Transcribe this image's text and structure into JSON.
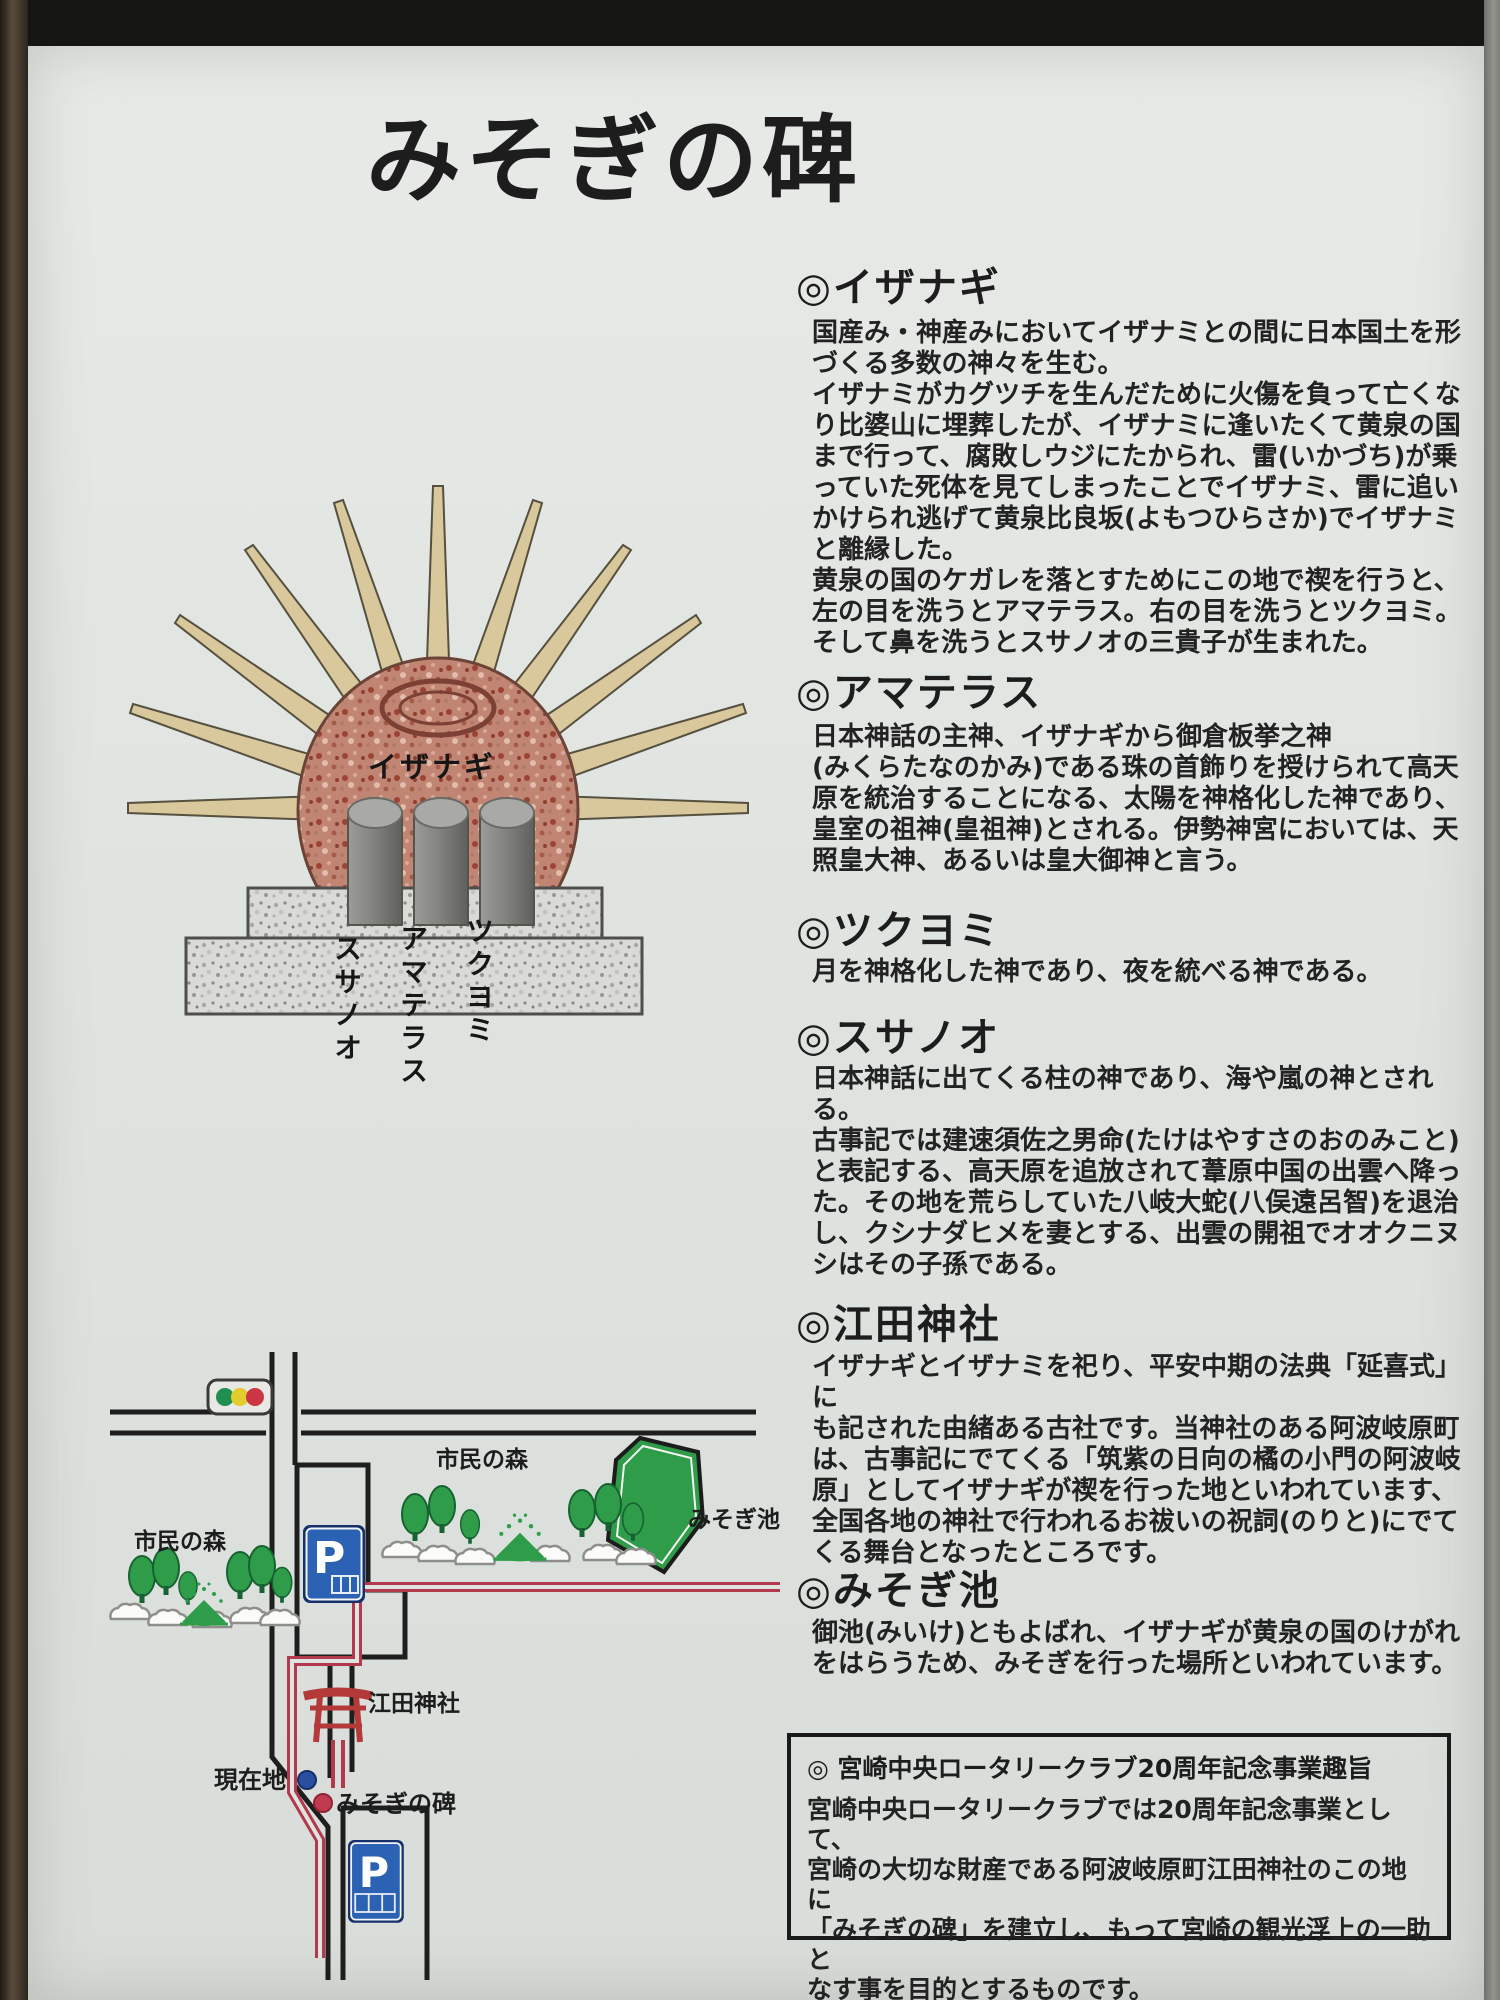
{
  "sign": {
    "title": "みそぎの碑",
    "sections": [
      {
        "heading": "◎イザナギ",
        "body": "国産み・神産みにおいてイザナミとの間に日本国土を形\nづくる多数の神々を生む。\nイザナミがカグツチを生んだために火傷を負って亡くな\nり比婆山に埋葬したが、イザナミに逢いたくて黄泉の国\nまで行って、腐敗しウジにたかられ、雷(いかづち)が乗\nっていた死体を見てしまったことでイザナミ、雷に追い\nかけられ逃げて黄泉比良坂(よもつひらさか)でイザナミ\nと離縁した。\n黄泉の国のケガレを落とすためにこの地で禊を行うと、\n左の目を洗うとアマテラス。右の目を洗うとツクヨミ。\nそして鼻を洗うとスサノオの三貴子が生まれた。"
      },
      {
        "heading": "◎アマテラス",
        "body": "日本神話の主神、イザナギから御倉板挙之神\n(みくらたなのかみ)である珠の首飾りを授けられて高天\n原を統治することになる、太陽を神格化した神であり、\n皇室の祖神(皇祖神)とされる。伊勢神宮においては、天\n照皇大神、あるいは皇大御神と言う。"
      },
      {
        "heading": "◎ツクヨミ",
        "body": "月を神格化した神であり、夜を統べる神である。"
      },
      {
        "heading": "◎スサノオ",
        "body": "日本神話に出てくる柱の神であり、海や嵐の神とされる。\n古事記では建速須佐之男命(たけはやすさのおのみこと)\nと表記する、高天原を追放されて葦原中国の出雲へ降っ\nた。その地を荒らしていた八岐大蛇(八俣遠呂智)を退治\nし、クシナダヒメを妻とする、出雲の開祖でオオクニヌ\nシはその子孫である。"
      },
      {
        "heading": "◎江田神社",
        "body": "イザナギとイザナミを祀り、平安中期の法典「延喜式」に\nも記された由緒ある古社です。当神社のある阿波岐原町\nは、古事記にでてくる「筑紫の日向の橘の小門の阿波岐\n原」としてイザナギが禊を行った地といわれています、\n全国各地の神社で行われるお祓いの祝詞(のりと)にでて\nくる舞台となったところです。"
      },
      {
        "heading": "◎みそぎ池",
        "body": "御池(みいけ)ともよばれ、イザナギが黄泉の国のけがれ\nをはらうため、みそぎを行った場所といわれています。"
      }
    ],
    "notice": {
      "heading": "◎ 宮崎中央ロータリークラブ20周年記念事業趣旨",
      "body": "宮崎中央ロータリークラブでは20周年記念事業として、\n宮崎の大切な財産である阿波岐原町江田神社のこの地に\n「みそぎの碑」を建立し、もって宮崎の観光浮上の一助と\nなす事を目的とするものです。"
    },
    "monument": {
      "stone_label": "イザナギ",
      "pedestal_labels": [
        "ツクヨミ",
        "アマテラス",
        "スサノオ"
      ]
    },
    "map": {
      "forest_right": "市民の森",
      "forest_left": "市民の森",
      "pond": "みそぎ池",
      "shrine": "江田神社",
      "current_location": "現在地",
      "monument": "みそぎの碑",
      "parking_symbol": "P"
    },
    "colors": {
      "panel": "#e0e4e0",
      "text": "#222222",
      "route_red": "#b23a4c",
      "road_black": "#1e1e1e",
      "tree_green": "#2e9c48",
      "parking_blue": "#2b62b4",
      "ray_tan": "#d9c89c",
      "stone_pink": "#c08573",
      "signal_green": "#1f9050",
      "signal_yellow": "#e3cc2e",
      "signal_red": "#cc3644"
    }
  }
}
